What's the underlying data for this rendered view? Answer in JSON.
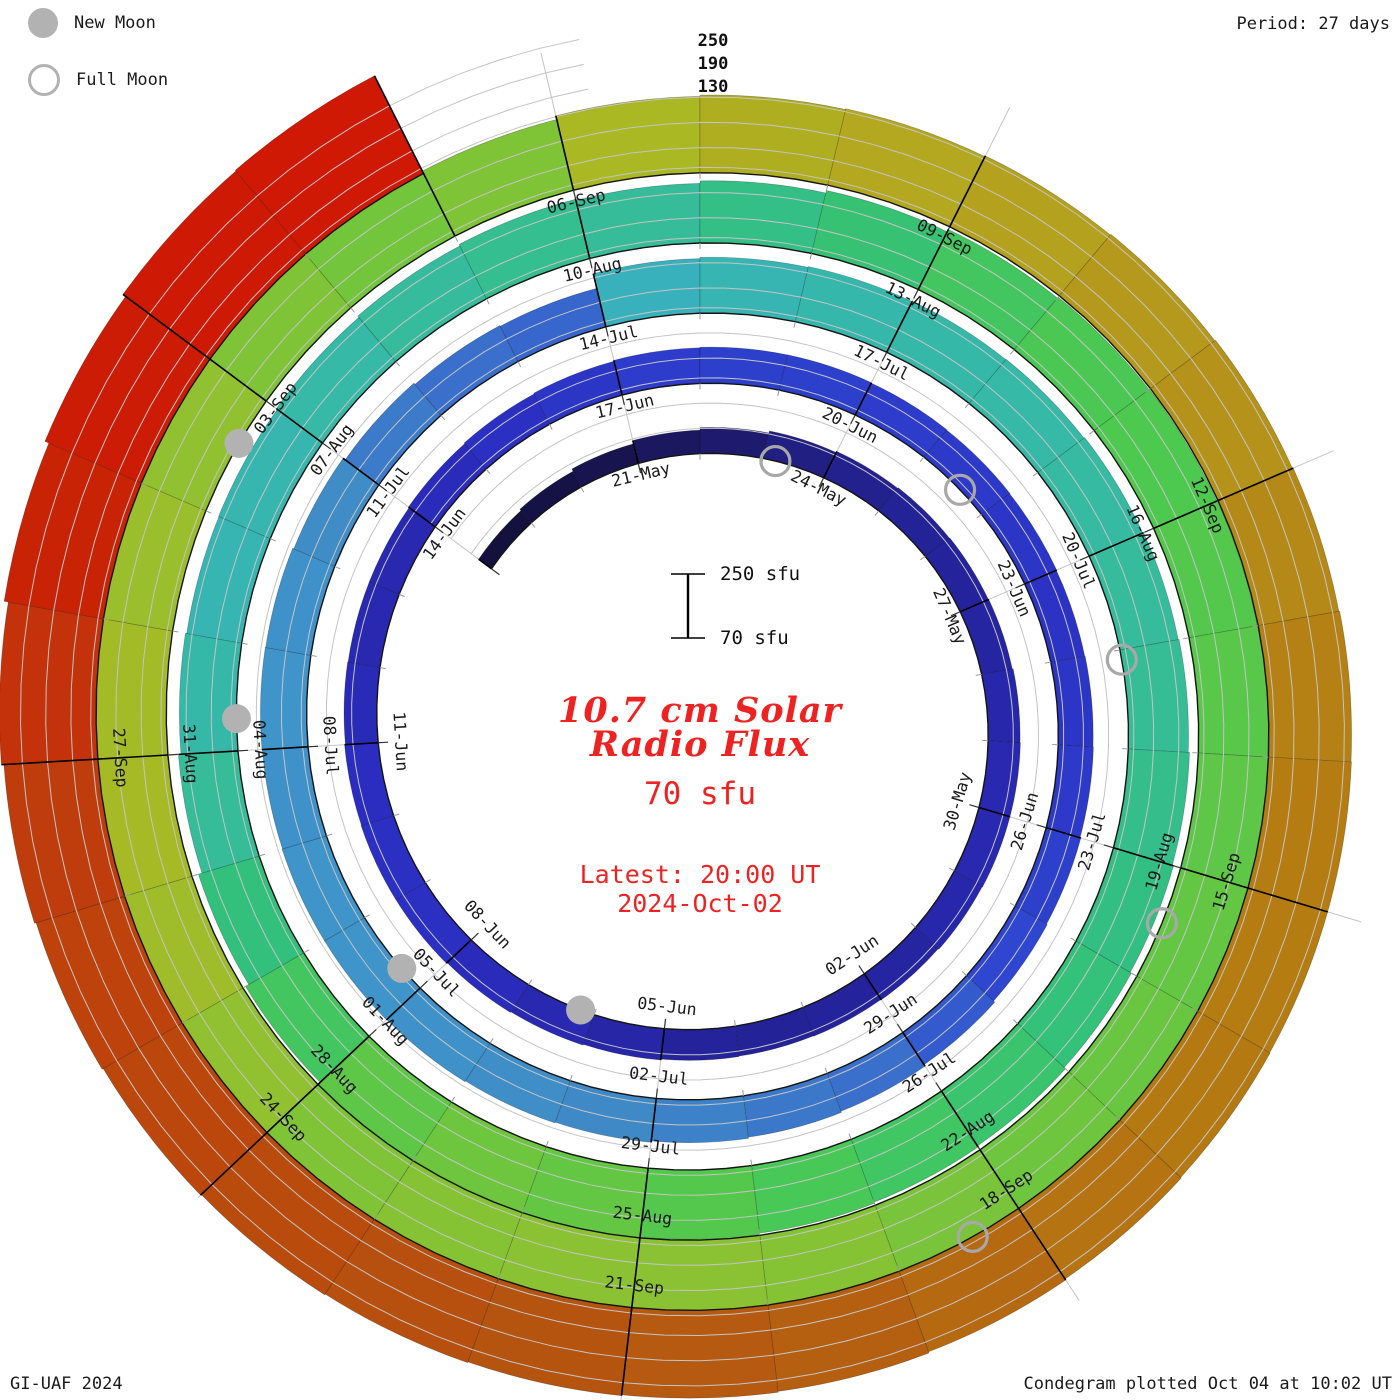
{
  "header": {
    "period_label": "Period: 27 days"
  },
  "legend": {
    "new_moon": "New Moon",
    "full_moon": "Full Moon"
  },
  "footer": {
    "left": "GI-UAF 2024",
    "right": "Condegram plotted Oct 04 at 10:02 UT"
  },
  "center": {
    "title_line1": "10.7 cm Solar",
    "title_line2": "Radio Flux",
    "current_flux": "70 sfu",
    "latest_line1": "Latest: 20:00 UT",
    "latest_line2": "2024-Oct-02",
    "accent_color": "#ef2222"
  },
  "scale_bar": {
    "top_label": "250 sfu",
    "bottom_label": "70 sfu",
    "x": 688,
    "y_top": 574,
    "y_bottom": 638,
    "cap_half_width": 17,
    "label_x": 720
  },
  "radial_axis": {
    "labels": [
      "250",
      "190",
      "130"
    ],
    "x": 713,
    "ys": [
      46,
      69,
      92
    ]
  },
  "chart_data": {
    "type": "bar",
    "subtype": "condegram_spiral",
    "title": "10.7 cm Solar Radio Flux",
    "units": "sfu",
    "period_days": 27,
    "plot_direction": "clockwise",
    "angle_zero": "top",
    "start_date": "2024-05-18",
    "end_date": "2024-10-02",
    "baseline_sfu": 70,
    "gridline_sfu": [
      130,
      190,
      250
    ],
    "date_labels": [
      "21-May",
      "24-May",
      "27-May",
      "30-May",
      "02-Jun",
      "05-Jun",
      "08-Jun",
      "11-Jun",
      "14-Jun",
      "17-Jun",
      "20-Jun",
      "23-Jun",
      "26-Jun",
      "29-Jun",
      "02-Jul",
      "05-Jul",
      "08-Jul",
      "11-Jul",
      "14-Jul",
      "17-Jul",
      "20-Jul",
      "23-Jul",
      "26-Jul",
      "29-Jul",
      "01-Aug",
      "04-Aug",
      "07-Aug",
      "10-Aug",
      "13-Aug",
      "16-Aug",
      "19-Aug",
      "22-Aug",
      "25-Aug",
      "28-Aug",
      "31-Aug",
      "03-Sep",
      "06-Sep",
      "09-Sep",
      "12-Sep",
      "15-Sep",
      "18-Sep",
      "21-Sep",
      "24-Sep",
      "27-Sep"
    ],
    "label_start_offset": 3,
    "label_step_days": 3,
    "daily_flux_sfu": [
      108,
      112,
      118,
      126,
      132,
      137,
      140,
      142,
      143,
      144,
      146,
      147,
      147,
      146,
      144,
      143,
      142,
      143,
      145,
      147,
      149,
      151,
      151,
      150,
      148,
      147,
      147,
      149,
      151,
      153,
      155,
      156,
      156,
      155,
      154,
      153,
      152,
      153,
      154,
      156,
      158,
      162,
      166,
      169,
      172,
      175,
      177,
      179,
      180,
      180,
      179,
      180,
      179,
      176,
      170,
      166,
      164,
      200,
      203,
      205,
      206,
      207,
      209,
      211,
      213,
      216,
      219,
      222,
      226,
      229,
      232,
      235,
      238,
      240,
      237,
      230,
      221,
      212,
      206,
      203,
      204,
      207,
      211,
      215,
      212,
      218,
      224,
      230,
      233,
      234,
      235,
      236,
      237,
      238,
      239,
      240,
      242,
      244,
      245,
      245,
      244,
      243,
      246,
      249,
      251,
      250,
      248,
      246,
      243,
      241,
      243,
      252,
      255,
      257,
      259,
      261,
      263,
      265,
      267,
      268,
      268,
      269,
      271,
      274,
      277,
      279,
      281,
      283,
      285,
      287,
      290,
      294,
      300,
      310,
      320,
      328,
      330,
      70
    ],
    "moons": {
      "new_moon_day_offsets": [
        19.2,
        48.3,
        78.3,
        107.6
      ],
      "new_moon_dates": [
        "2024-06-06",
        "2024-07-05",
        "2024-08-04",
        "2024-09-03"
      ],
      "full_moon_day_offsets": [
        5.2,
        34.6,
        64.1,
        93.5,
        123.4
      ],
      "full_moon_dates": [
        "2024-05-23",
        "2024-06-22",
        "2024-07-21",
        "2024-08-19",
        "2024-09-18"
      ]
    },
    "colormap_value_to_color": [
      [
        70,
        "#0b0918"
      ],
      [
        100,
        "#120f33"
      ],
      [
        120,
        "#171452"
      ],
      [
        132,
        "#1e1b6e"
      ],
      [
        142,
        "#232296"
      ],
      [
        150,
        "#2b2cc0"
      ],
      [
        158,
        "#2e46d0"
      ],
      [
        166,
        "#3a70cc"
      ],
      [
        176,
        "#3f8cc6"
      ],
      [
        186,
        "#3fa0cf"
      ],
      [
        197,
        "#3aaec6"
      ],
      [
        205,
        "#36b7ac"
      ],
      [
        213,
        "#36bd96"
      ],
      [
        221,
        "#32c07c"
      ],
      [
        228,
        "#3dc567"
      ],
      [
        234,
        "#4ec94f"
      ],
      [
        241,
        "#73c53c"
      ],
      [
        247,
        "#97c02e"
      ],
      [
        252,
        "#aab823"
      ],
      [
        257,
        "#b3a81f"
      ],
      [
        263,
        "#b5921a"
      ],
      [
        268,
        "#b57c12"
      ],
      [
        274,
        "#b56911"
      ],
      [
        281,
        "#b5540f"
      ],
      [
        288,
        "#bc450c"
      ],
      [
        295,
        "#c03c0c"
      ],
      [
        303,
        "#c52c08"
      ],
      [
        315,
        "#cb1d05"
      ],
      [
        335,
        "#d01804"
      ]
    ],
    "layout": {
      "cx": 700,
      "cy": 724,
      "r0": 260,
      "px_per_day_radial": 2.6,
      "px_per_sfu": 0.42,
      "angle_ref_day": 112,
      "deg_per_day": 13.3333333,
      "label_inset": 17,
      "moon_radius": 14.5,
      "grid_color": "#c4c4c4",
      "baseline_color": "#141414"
    }
  }
}
